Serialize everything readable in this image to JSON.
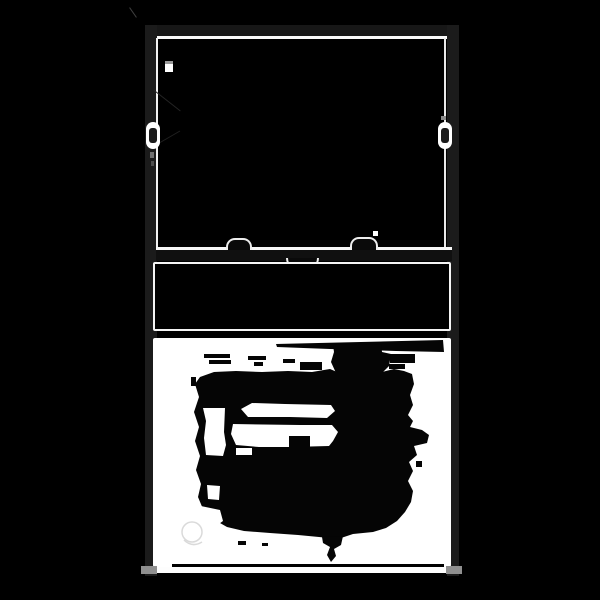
{
  "canvas": {
    "width": 600,
    "height": 600,
    "background": "#000000"
  },
  "illustration": {
    "kind": "double-hung window, black-and-white thresholded illustration",
    "colors": {
      "background": "#000000",
      "frame": "#1b1b1b",
      "outline": "#fafafa",
      "hardware_fill": "#0a0a0a",
      "panel": "#ffffff",
      "silhouette": "#050505",
      "feet": "#8f8f8f"
    },
    "parts": {
      "frame_head": "Window frame head",
      "frame_jamb_left": "Window frame left jamb",
      "frame_jamb_right": "Window frame right jamb",
      "upper_sash": "Upper sash (dark glass)",
      "vent_stop": "Vent stop block",
      "tilt_latch_left": "Left side tilt latch",
      "tilt_latch_right": "Right side tilt latch",
      "meeting_rail": "Meeting rail",
      "rail_tilt_latch_left": "Left rail tilt latch bump",
      "rail_tilt_latch_right": "Right rail tilt latch bump",
      "sash_lock": "Center sash lock",
      "lower_sash": "Lower sash (dark glass)",
      "bottom_panel": "Bottom panel / screen (white)",
      "silhouette": "Dark irregular silhouette on bottom panel",
      "sill": "Window sill",
      "foot_left": "Left sill foot",
      "foot_right": "Right sill foot"
    }
  }
}
